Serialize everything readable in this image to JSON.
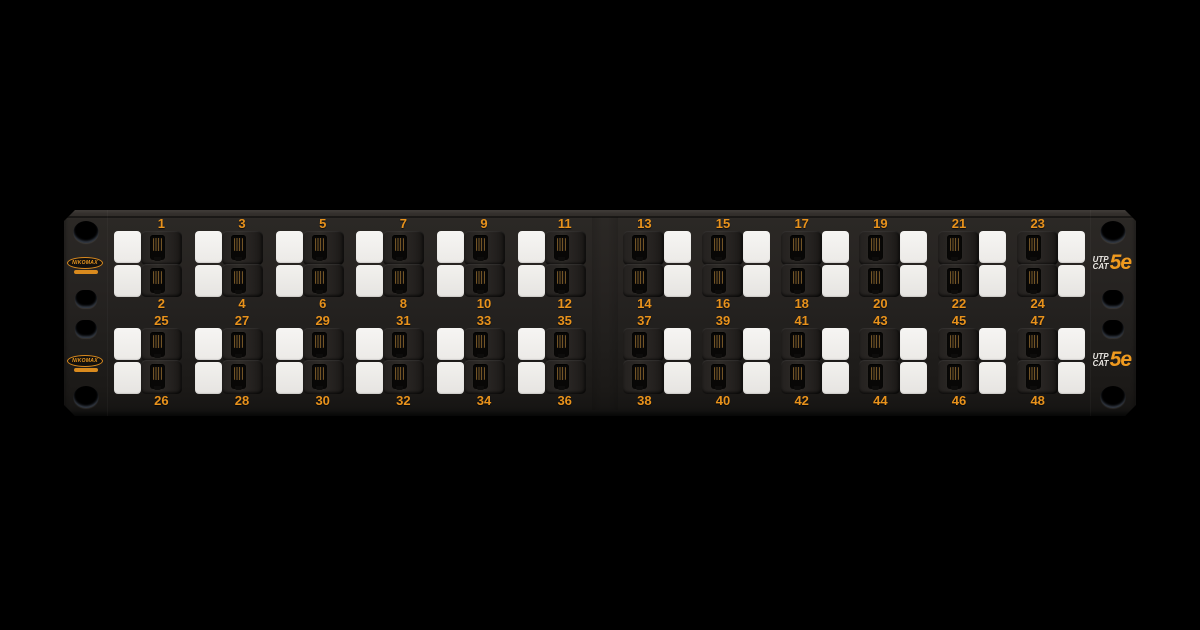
{
  "product": {
    "brand": "NIKOMAX",
    "rating_line1": "UTP",
    "rating_line2": "CAT",
    "rating_grade": "5e",
    "type": "48-port keystone patch panel, 2U rack mount"
  },
  "colors": {
    "background": "#000000",
    "panel_dark": "#232120",
    "accent_orange": "#E8921C",
    "grade_orange": "#EF9A1F",
    "label_white": "#F2F1EE",
    "rating_white": "#ECE9E4"
  },
  "ports": {
    "rows": [
      {
        "halves": [
          {
            "side": "left",
            "modules": [
              {
                "top": 1,
                "bottom": 2
              },
              {
                "top": 3,
                "bottom": 4
              },
              {
                "top": 5,
                "bottom": 6
              },
              {
                "top": 7,
                "bottom": 8
              },
              {
                "top": 9,
                "bottom": 10
              },
              {
                "top": 11,
                "bottom": 12
              }
            ]
          },
          {
            "side": "right",
            "modules": [
              {
                "top": 13,
                "bottom": 14
              },
              {
                "top": 15,
                "bottom": 16
              },
              {
                "top": 17,
                "bottom": 18
              },
              {
                "top": 19,
                "bottom": 20
              },
              {
                "top": 21,
                "bottom": 22
              },
              {
                "top": 23,
                "bottom": 24
              }
            ]
          }
        ]
      },
      {
        "halves": [
          {
            "side": "left",
            "modules": [
              {
                "top": 25,
                "bottom": 26
              },
              {
                "top": 27,
                "bottom": 28
              },
              {
                "top": 29,
                "bottom": 30
              },
              {
                "top": 31,
                "bottom": 32
              },
              {
                "top": 33,
                "bottom": 34
              },
              {
                "top": 35,
                "bottom": 36
              }
            ]
          },
          {
            "side": "right",
            "modules": [
              {
                "top": 37,
                "bottom": 38
              },
              {
                "top": 39,
                "bottom": 40
              },
              {
                "top": 41,
                "bottom": 42
              },
              {
                "top": 43,
                "bottom": 44
              },
              {
                "top": 45,
                "bottom": 46
              },
              {
                "top": 47,
                "bottom": 48
              }
            ]
          }
        ]
      }
    ]
  }
}
